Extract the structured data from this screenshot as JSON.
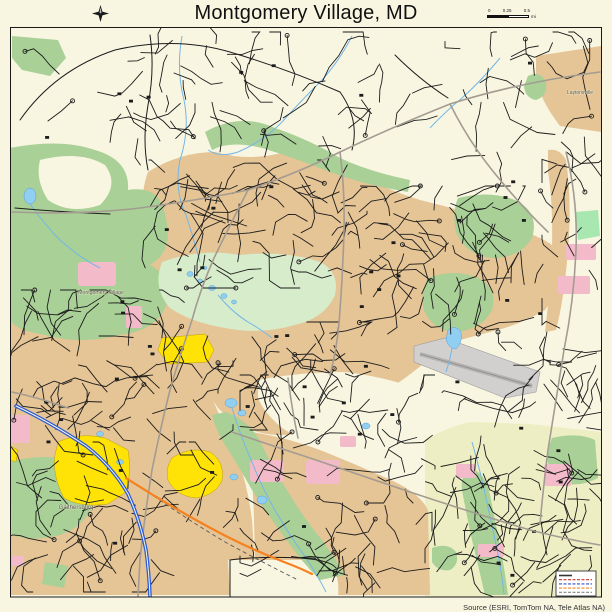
{
  "header": {
    "title": "Montgomery Village, MD"
  },
  "scalebar": {
    "ticks": [
      "0",
      "0.25",
      "0.5"
    ],
    "unit": "mi"
  },
  "map": {
    "labels": [
      {
        "text": "Montgomery Village",
        "x": 101,
        "y": 294,
        "size": 5.2
      },
      {
        "text": "Gaithersburg",
        "x": 76,
        "y": 509,
        "size": 6
      },
      {
        "text": "Laytonsville",
        "x": 580,
        "y": 94,
        "size": 5
      }
    ]
  },
  "legend_inset": {
    "line_colors": [
      "#333333",
      "#cc3333",
      "#3355cc",
      "#f58220",
      "#888888"
    ]
  },
  "footer": {
    "attribution": "Source (ESRI, TomTom NA, Tele Atlas NA)"
  },
  "colors": {
    "cream": "#f8f6e1",
    "tan": "#e5c495",
    "green": "#a9d096",
    "mint": "#d7ecca",
    "bright_green": "#a8e8b0",
    "pale": "#edeec3",
    "yellow": "#ffe206",
    "yellow_stroke": "#bfa000",
    "pink": "#f3bac9",
    "water": "#90cff2",
    "water_stroke": "#58a0d8",
    "stream": "#74b6e8",
    "road_gray": "#a49c92",
    "street": "#1c1c1c",
    "orange": "#f58220",
    "highway_blue": "#2e5dd4",
    "airport": "#d2d0ce",
    "label": "#55554b",
    "title": "#101010"
  }
}
